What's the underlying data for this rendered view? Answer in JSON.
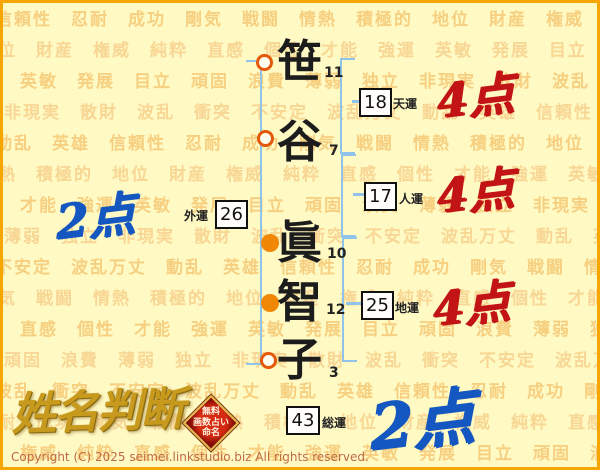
{
  "name_analysis": {
    "characters": [
      {
        "char": "笹",
        "strokes": "11",
        "marker": "hollow"
      },
      {
        "char": "谷",
        "strokes": "7",
        "marker": "hollow"
      },
      {
        "char": "眞",
        "strokes": "10",
        "marker": "filled"
      },
      {
        "char": "智",
        "strokes": "12",
        "marker": "filled"
      },
      {
        "char": "子",
        "strokes": "3",
        "marker": "hollow"
      }
    ],
    "fortunes": [
      {
        "id": "tenun",
        "value": "18",
        "label": "天運",
        "score": "4点"
      },
      {
        "id": "jinun",
        "value": "17",
        "label": "人運",
        "score": "4点"
      },
      {
        "id": "gaiun",
        "value": "26",
        "label": "外運",
        "score": "2点"
      },
      {
        "id": "chiun",
        "value": "25",
        "label": "地運",
        "score": "4点"
      },
      {
        "id": "souun",
        "value": "43",
        "label": "総運",
        "score": "2点"
      }
    ]
  },
  "footer": {
    "logo": "姓名判断",
    "stamp_lines": [
      "無料",
      "画数占い",
      "命名"
    ],
    "copyright": "Copyright (C) 2025 seimei.linkstudio.biz All rights reserved."
  },
  "watermark": {
    "words": [
      "信頼性",
      "忍耐",
      "成功",
      "剛気",
      "戦闘",
      "情熱",
      "積極的",
      "地位",
      "財産",
      "権威",
      "純粋",
      "直感",
      "個性",
      "才能",
      "強運",
      "英敏",
      "発展",
      "目立",
      "頑固",
      "浪費",
      "薄弱",
      "独立",
      "非現実",
      "散財",
      "波乱",
      "衝突",
      "不安定",
      "波乱万丈",
      "動乱",
      "英雄"
    ]
  },
  "colors": {
    "frame_orange": "#F7A600",
    "background": "#FFF9C4",
    "watermark_text": "#F2B758",
    "bracket_blue": "#8FC3EA",
    "marker_ring": "#E4580A",
    "marker_fill": "#F08705",
    "score_red": "#C21414",
    "score_blue": "#1457C0",
    "logo_gold": "#C79A1E",
    "stamp_red": "#B91C0C"
  }
}
